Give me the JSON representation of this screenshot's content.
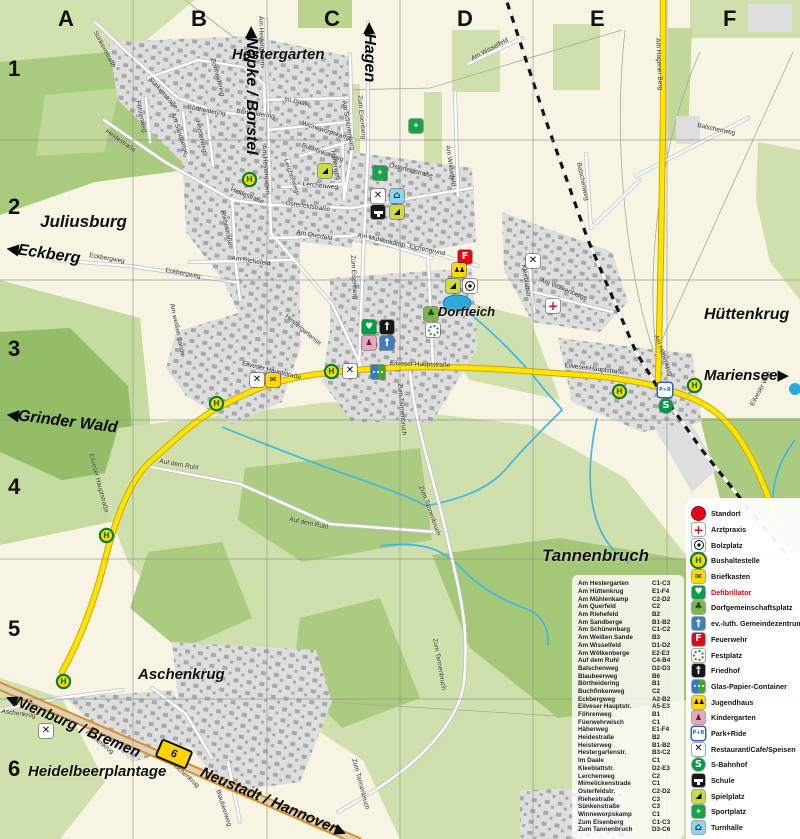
{
  "colors": {
    "field": "#cfe0ac",
    "forest": "#9cc272",
    "urban": "#dedede",
    "main_road": "#ffe400",
    "b_road_edge": "#e08e1e",
    "water": "#3db7e4",
    "bus_green": "#0b7d2f",
    "alert_red": "#e30613"
  },
  "grid": {
    "columns": [
      "A",
      "B",
      "C",
      "D",
      "E",
      "F"
    ],
    "col_x": [
      58,
      191,
      324,
      457,
      590,
      723
    ],
    "label_top": 6,
    "rows": [
      "1",
      "2",
      "3",
      "4",
      "5",
      "6"
    ],
    "row_y": [
      56,
      194,
      336,
      474,
      616,
      756
    ],
    "label_left": 8
  },
  "route_badge": "6",
  "places": [
    {
      "t": "Hestergarten",
      "x": 232,
      "y": 46,
      "s": 15
    },
    {
      "t": "Juliusburg",
      "x": 40,
      "y": 212,
      "s": 17
    },
    {
      "t": "Hüttenkrug",
      "x": 704,
      "y": 306,
      "s": 16
    },
    {
      "t": "Dorfteich",
      "x": 438,
      "y": 304,
      "s": 13
    },
    {
      "t": "Tannenbruch",
      "x": 542,
      "y": 546,
      "s": 17
    },
    {
      "t": "Aschenkrug",
      "x": 138,
      "y": 666,
      "s": 15
    },
    {
      "t": "Heidelbeerplantage",
      "x": 28,
      "y": 763,
      "s": 15
    }
  ],
  "direction_signs": [
    {
      "t": "Nöpke / Borstel",
      "arrow": "left",
      "x": 262,
      "y": 26,
      "r": 90,
      "s": 16
    },
    {
      "t": "Hagen",
      "arrow": "left",
      "x": 380,
      "y": 22,
      "r": 90,
      "s": 16
    },
    {
      "t": "Eckberg",
      "arrow": "left",
      "x": 8,
      "y": 238,
      "r": 8,
      "s": 16
    },
    {
      "t": "Grinder Wald",
      "arrow": "left",
      "x": 8,
      "y": 404,
      "r": 7,
      "s": 16
    },
    {
      "t": "Mariensee",
      "arrow": "right",
      "x": 704,
      "y": 366,
      "r": 0,
      "s": 15
    },
    {
      "t": "Nienburg / Bremen",
      "arrow": "left",
      "x": 10,
      "y": 688,
      "r": 23,
      "s": 15
    },
    {
      "t": "Neustadt / Hannover",
      "arrow": "right",
      "x": 205,
      "y": 763,
      "r": 23,
      "s": 15
    }
  ],
  "streets": [
    {
      "t": "Sünkenstraße",
      "x": 98,
      "y": 30,
      "r": 62
    },
    {
      "t": "Sünkenstraße",
      "x": 152,
      "y": 76,
      "r": 48
    },
    {
      "t": "Föhrenweg",
      "x": 141,
      "y": 100,
      "r": 78
    },
    {
      "t": "Börtheidering",
      "x": 188,
      "y": 104,
      "r": 10
    },
    {
      "t": "Börtheidering",
      "x": 237,
      "y": 108,
      "r": 8
    },
    {
      "t": "Börtheidering",
      "x": 216,
      "y": 58,
      "r": 75
    },
    {
      "t": "Heidestraße",
      "x": 108,
      "y": 128,
      "r": 35
    },
    {
      "t": "Heidestraße",
      "x": 232,
      "y": 186,
      "r": 22
    },
    {
      "t": "Am Hestergarten",
      "x": 264,
      "y": 16,
      "r": 88
    },
    {
      "t": "Am Hestergarten",
      "x": 267,
      "y": 145,
      "r": 85
    },
    {
      "t": "Im Daale",
      "x": 285,
      "y": 96,
      "r": 12
    },
    {
      "t": "Winneworpskamp",
      "x": 303,
      "y": 120,
      "r": 18
    },
    {
      "t": "Am Sandberge",
      "x": 176,
      "y": 112,
      "r": 72
    },
    {
      "t": "Heisterweg",
      "x": 201,
      "y": 120,
      "r": 78
    },
    {
      "t": "Am Schünenbarg",
      "x": 347,
      "y": 100,
      "r": 80
    },
    {
      "t": "Zum Eisenberg",
      "x": 363,
      "y": 95,
      "r": 85
    },
    {
      "t": "Zum Eisenberg",
      "x": 356,
      "y": 255,
      "r": 87
    },
    {
      "t": "Häherweg",
      "x": 336,
      "y": 150,
      "r": 80
    },
    {
      "t": "Buchfinkenweg",
      "x": 303,
      "y": 142,
      "r": 20
    },
    {
      "t": "Lerchenweg",
      "x": 289,
      "y": 158,
      "r": 72
    },
    {
      "t": "Lerchenweg",
      "x": 303,
      "y": 181,
      "r": 5
    },
    {
      "t": "Osterfeldstraße",
      "x": 286,
      "y": 200,
      "r": 8
    },
    {
      "t": "Osterfeldstraße",
      "x": 390,
      "y": 162,
      "r": 14
    },
    {
      "t": "Am Querfeld",
      "x": 297,
      "y": 229,
      "r": 10
    },
    {
      "t": "Riehestraße",
      "x": 226,
      "y": 210,
      "r": 78
    },
    {
      "t": "Am Riehefeld",
      "x": 232,
      "y": 255,
      "r": 8
    },
    {
      "t": "Eckbergweg",
      "x": 90,
      "y": 252,
      "r": 10
    },
    {
      "t": "Eckbergweg",
      "x": 166,
      "y": 267,
      "r": 10
    },
    {
      "t": "Am Mühlenkamp",
      "x": 358,
      "y": 232,
      "r": 12
    },
    {
      "t": "Eichengrund",
      "x": 410,
      "y": 243,
      "r": 12
    },
    {
      "t": "Am Wisselfeld",
      "x": 470,
      "y": 56,
      "r": -28
    },
    {
      "t": "Am Wisselfeld",
      "x": 451,
      "y": 145,
      "r": 82
    },
    {
      "t": "Am weißen Sande",
      "x": 175,
      "y": 303,
      "r": 78
    },
    {
      "t": "Hestergartenstr.",
      "x": 288,
      "y": 313,
      "r": 40
    },
    {
      "t": "Eilveser Hauptstraße",
      "x": 243,
      "y": 360,
      "r": 14
    },
    {
      "t": "Eilveser Hauptstraße",
      "x": 390,
      "y": 360,
      "r": 2
    },
    {
      "t": "Eilveser Hauptstraße",
      "x": 565,
      "y": 362,
      "r": 7
    },
    {
      "t": "Eilveser Hauptstraße",
      "x": 94,
      "y": 453,
      "r": 75
    },
    {
      "t": "Auf dem Ruhl",
      "x": 160,
      "y": 458,
      "r": 10
    },
    {
      "t": "Auf dem Ruhl",
      "x": 290,
      "y": 516,
      "r": 12
    },
    {
      "t": "Zum Tannenbruch",
      "x": 403,
      "y": 383,
      "r": 85
    },
    {
      "t": "Zum Tannenbruch",
      "x": 424,
      "y": 485,
      "r": 70
    },
    {
      "t": "Zum Tannenbruch",
      "x": 438,
      "y": 638,
      "r": 80
    },
    {
      "t": "Zum Tannenbruch",
      "x": 357,
      "y": 758,
      "r": 75
    },
    {
      "t": "Balschenweg",
      "x": 582,
      "y": 162,
      "r": 78
    },
    {
      "t": "Balschenweg",
      "x": 698,
      "y": 122,
      "r": 12
    },
    {
      "t": "Am Hagener Berg",
      "x": 661,
      "y": 38,
      "r": 87
    },
    {
      "t": "Am Hüttenkrug",
      "x": 659,
      "y": 334,
      "r": 70
    },
    {
      "t": "Kleeblattstr.",
      "x": 527,
      "y": 264,
      "r": 82
    },
    {
      "t": "Am Wölkenberge",
      "x": 542,
      "y": 277,
      "r": 22
    },
    {
      "t": "Eilveser Weg",
      "x": 749,
      "y": 404,
      "r": -62
    },
    {
      "t": "Aschenkrug",
      "x": 2,
      "y": 708,
      "r": 8
    },
    {
      "t": "Aschenkrug",
      "x": 88,
      "y": 729,
      "r": 38
    },
    {
      "t": "Aschenkrug",
      "x": 175,
      "y": 761,
      "r": 42
    },
    {
      "t": "Blaubeerweg",
      "x": 221,
      "y": 789,
      "r": 72
    }
  ],
  "map_icons": [
    {
      "type": "bushaltestelle",
      "x": 244,
      "y": 174
    },
    {
      "type": "bushaltestelle",
      "x": 211,
      "y": 398
    },
    {
      "type": "bushaltestelle",
      "x": 326,
      "y": 366
    },
    {
      "type": "bushaltestelle",
      "x": 101,
      "y": 530
    },
    {
      "type": "bushaltestelle",
      "x": 58,
      "y": 676
    },
    {
      "type": "bushaltestelle",
      "x": 614,
      "y": 386
    },
    {
      "type": "bushaltestelle",
      "x": 689,
      "y": 380
    },
    {
      "type": "restaurant",
      "x": 371,
      "y": 189
    },
    {
      "type": "restaurant",
      "x": 250,
      "y": 373
    },
    {
      "type": "restaurant",
      "x": 343,
      "y": 364
    },
    {
      "type": "restaurant",
      "x": 526,
      "y": 254
    },
    {
      "type": "restaurant",
      "x": 39,
      "y": 724
    },
    {
      "type": "briefkasten",
      "x": 266,
      "y": 373
    },
    {
      "type": "turnhalle",
      "x": 390,
      "y": 189
    },
    {
      "type": "schule",
      "x": 371,
      "y": 205
    },
    {
      "type": "spielplatz",
      "x": 390,
      "y": 205
    },
    {
      "type": "spielplatz",
      "x": 318,
      "y": 164
    },
    {
      "type": "spielplatz",
      "x": 446,
      "y": 279
    },
    {
      "type": "bolzplatz",
      "x": 463,
      "y": 279
    },
    {
      "type": "sportplatz",
      "x": 409,
      "y": 119
    },
    {
      "type": "sportplatz",
      "x": 373,
      "y": 166
    },
    {
      "type": "feuerwehr",
      "x": 458,
      "y": 250
    },
    {
      "type": "jugendhaus",
      "x": 452,
      "y": 263
    },
    {
      "type": "dorfgemeinschaftsplatz",
      "x": 424,
      "y": 307
    },
    {
      "type": "festplatz",
      "x": 426,
      "y": 323
    },
    {
      "type": "defibrillator",
      "x": 362,
      "y": 320
    },
    {
      "type": "friedhof",
      "x": 380,
      "y": 320
    },
    {
      "type": "kindergarten",
      "x": 362,
      "y": 336
    },
    {
      "type": "gemeindezentrum",
      "x": 380,
      "y": 336
    },
    {
      "type": "arztpraxis",
      "x": 546,
      "y": 299
    },
    {
      "type": "park-ride",
      "x": 658,
      "y": 383
    },
    {
      "type": "s-bahnhof",
      "x": 659,
      "y": 399
    },
    {
      "type": "glas-container",
      "x": 371,
      "y": 365
    }
  ],
  "legend": {
    "items": [
      {
        "type": "standort",
        "label": "Standort"
      },
      {
        "type": "arztpraxis",
        "label": "Arztpraxis"
      },
      {
        "type": "bolzplatz",
        "label": "Bolzplatz"
      },
      {
        "type": "bushaltestelle",
        "label": "Bushaltestelle"
      },
      {
        "type": "briefkasten",
        "label": "Briefkasten"
      },
      {
        "type": "defibrillator",
        "label": "Defibrillator",
        "red": true
      },
      {
        "type": "dorfgemeinschaftsplatz",
        "label": "Dorfgemeinschaftsplatz"
      },
      {
        "type": "gemeindezentrum",
        "label": "ev.-luth. Gemeindezentrum"
      },
      {
        "type": "feuerwehr",
        "label": "Feuerwehr"
      },
      {
        "type": "festplatz",
        "label": "Festplatz"
      },
      {
        "type": "friedhof",
        "label": "Friedhof"
      },
      {
        "type": "glas-container",
        "label": "Glas-Papier-Container"
      },
      {
        "type": "jugendhaus",
        "label": "Jugendhaus"
      },
      {
        "type": "kindergarten",
        "label": "Kindergarten"
      },
      {
        "type": "park-ride",
        "label": "Park+Ride"
      },
      {
        "type": "restaurant",
        "label": "Restaurant/Cafe/Speisen"
      },
      {
        "type": "s-bahnhof",
        "label": "S-Bahnhof"
      },
      {
        "type": "schule",
        "label": "Schule"
      },
      {
        "type": "spielplatz",
        "label": "Spielplatz"
      },
      {
        "type": "sportplatz",
        "label": "Sportplatz"
      },
      {
        "type": "turnhalle",
        "label": "Turnhalle"
      }
    ]
  },
  "street_index": {
    "entries": [
      {
        "name": "Am Hestergarten",
        "grid": "C1-C3"
      },
      {
        "name": "Am Hüttenkrug",
        "grid": "E1-F4"
      },
      {
        "name": "Am Mühlenkamp",
        "grid": "C2-D2"
      },
      {
        "name": "Am Querfeld",
        "grid": "C2"
      },
      {
        "name": "Am Riehefeld",
        "grid": "B2"
      },
      {
        "name": "Am Sandberge",
        "grid": "B1-B2"
      },
      {
        "name": "Am Schünenbarg",
        "grid": "C1-C2"
      },
      {
        "name": "Am Weißen Sande",
        "grid": "B3"
      },
      {
        "name": "Am Wisselfeld",
        "grid": "D1-D2"
      },
      {
        "name": "Am Wölkenberge",
        "grid": "E2-E3"
      },
      {
        "name": "Auf dem Ruhl",
        "grid": "C4-B4"
      },
      {
        "name": "Balschenweg",
        "grid": "D2-D3"
      },
      {
        "name": "Blaubeerweg",
        "grid": "B6"
      },
      {
        "name": "Börtheidering",
        "grid": "B1"
      },
      {
        "name": "Buchfinkenweg",
        "grid": "C2"
      },
      {
        "name": "Eckbergweg",
        "grid": "A2-B2"
      },
      {
        "name": "Eilveser Hauptstr.",
        "grid": "A5-E3"
      },
      {
        "name": "Föhrenweg",
        "grid": "B1"
      },
      {
        "name": "Füerwehrwisch",
        "grid": "C1"
      },
      {
        "name": "Häherweg",
        "grid": "E1-F4"
      },
      {
        "name": "Heidestraße",
        "grid": "B2"
      },
      {
        "name": "Heisterweg",
        "grid": "B1-B2"
      },
      {
        "name": "Hestergartenstr.",
        "grid": "B3-C2"
      },
      {
        "name": "Im Daale",
        "grid": "C1"
      },
      {
        "name": "Kleeblattstr.",
        "grid": "D2-E3"
      },
      {
        "name": "Lerchenweg",
        "grid": "C2"
      },
      {
        "name": "Mimelickenstrade",
        "grid": "C1"
      },
      {
        "name": "Osterfeldstr.",
        "grid": "C2-D2"
      },
      {
        "name": "Riehestraße",
        "grid": "C3"
      },
      {
        "name": "Sünkenstraße",
        "grid": "C3"
      },
      {
        "name": "Winneworpskamp",
        "grid": "C1"
      },
      {
        "name": "Zum Eisenberg",
        "grid": "C1-C3"
      },
      {
        "name": "Zum Tannenbruch",
        "grid": "D3-C6"
      }
    ]
  }
}
